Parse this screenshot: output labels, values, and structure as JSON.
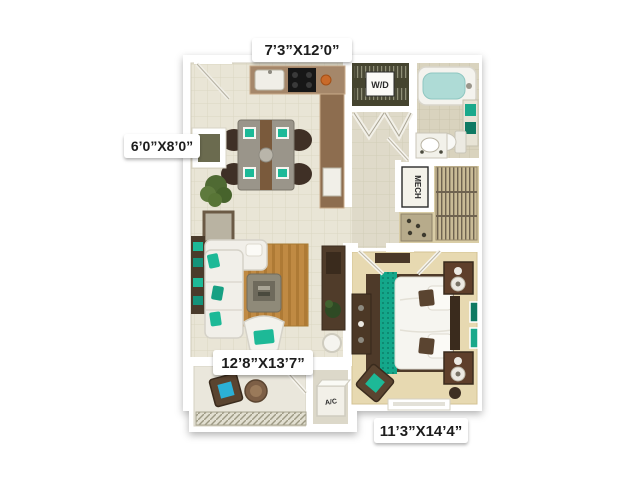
{
  "floorplan": {
    "dimensions": {
      "kitchen": "7’3”X12’0”",
      "patio": "6’0”X8’0”",
      "living": "12’8”X13’7”",
      "bedroom": "11’3”X14’4”"
    },
    "closet_labels": {
      "washer_dryer": "W/D",
      "mechanical": "MECH",
      "air_conditioning": "A/C"
    },
    "colors": {
      "accent_teal": "#1db997",
      "floor_tile": "#e9e5d6",
      "carpet": "#e7d9b1",
      "counter_wood": "#97775a",
      "furniture_dark": "#53402d",
      "rug_wood": "#c08a43",
      "wall": "#ffffff"
    }
  }
}
